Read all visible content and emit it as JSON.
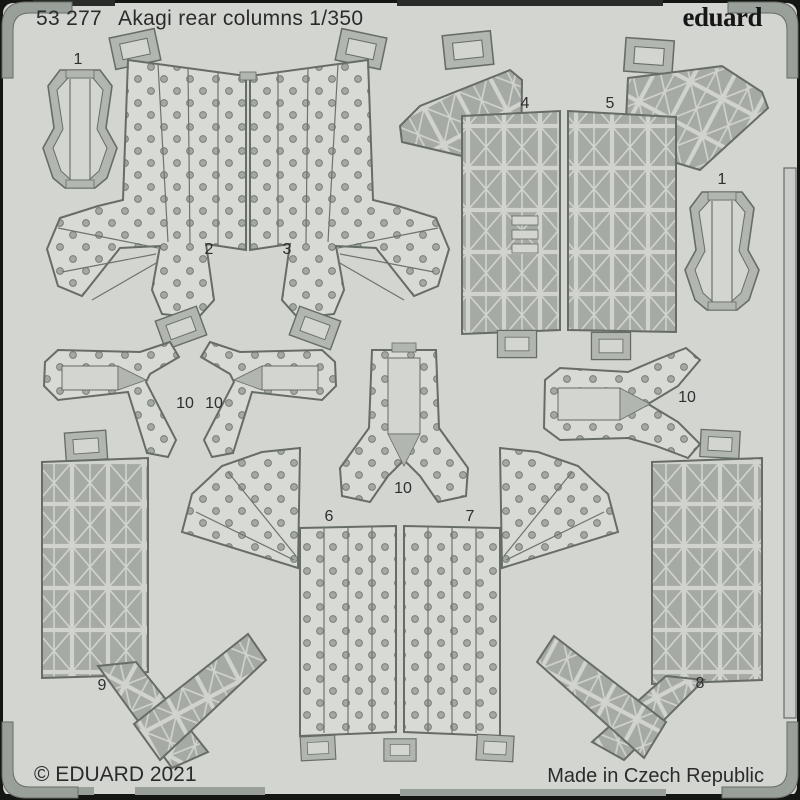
{
  "sheet": {
    "catalog_number": "53 277",
    "product_title": "Akagi rear columns 1/350",
    "brand_logo": "eduard",
    "copyright": "© EDUARD 2021",
    "made_in": "Made in Czech Republic"
  },
  "colors": {
    "background": "#141614",
    "sheet": "#d3d5d1",
    "panel_metal": "#d8dad5",
    "truss_metal": "#a6aaa4",
    "frame": "#99a099",
    "outline": "#666c66",
    "text": "#2b2b2b"
  },
  "part_labels": [
    {
      "label": "1",
      "x": 78,
      "y": 66
    },
    {
      "label": "2",
      "x": 209,
      "y": 256
    },
    {
      "label": "3",
      "x": 287,
      "y": 256
    },
    {
      "label": "4",
      "x": 525,
      "y": 110
    },
    {
      "label": "5",
      "x": 610,
      "y": 110
    },
    {
      "label": "1",
      "x": 722,
      "y": 186
    },
    {
      "label": "10",
      "x": 185,
      "y": 410
    },
    {
      "label": "10",
      "x": 214,
      "y": 410
    },
    {
      "label": "10",
      "x": 403,
      "y": 495
    },
    {
      "label": "10",
      "x": 687,
      "y": 404
    },
    {
      "label": "6",
      "x": 329,
      "y": 523
    },
    {
      "label": "7",
      "x": 470,
      "y": 523
    },
    {
      "label": "9",
      "x": 102,
      "y": 692
    },
    {
      "label": "8",
      "x": 700,
      "y": 690
    }
  ]
}
